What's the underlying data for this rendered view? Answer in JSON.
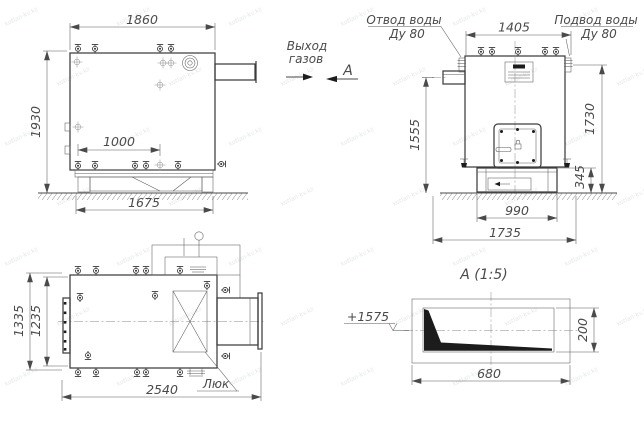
{
  "views": {
    "side": {
      "dim_top": "1860",
      "dim_left": "1930",
      "dim_inner": "1000",
      "dim_bottom": "1675",
      "gas_label_1": "Выход",
      "gas_label_2": "газов",
      "section_letter": "А"
    },
    "front": {
      "dim_top": "1405",
      "dim_left": "1555",
      "dim_right": "1730",
      "dim_base_h": "345",
      "dim_base_w": "990",
      "dim_ground": "1735",
      "outlet_label_1": "Отвод воды",
      "outlet_label_2": "Ду 80",
      "inlet_label_1": "Подвод воды",
      "inlet_label_2": "Ду 80"
    },
    "plan": {
      "dim_outer": "1335",
      "dim_inner": "1235",
      "dim_length": "2540",
      "hatch_label": "Люк"
    },
    "section": {
      "title": "А (1:5)",
      "dim_width": "680",
      "dim_height": "200",
      "elevation": "+1575"
    }
  },
  "icons": {
    "valve-icon": "handwheel-valve-glyph",
    "crosshair-icon": "position-target-cross",
    "flow-arrow-icon": "filled-right-arrow",
    "section-arrow-icon": "filled-left-arrow",
    "lock-icon": "padlock",
    "hatch-cross": "x-crossed-rectangle",
    "flange-port-icon": "concentric-circles-flange"
  },
  "watermark": {
    "text": "kotlan-kv.kz",
    "color": "#c9d2d9"
  },
  "colors": {
    "line": "#3d3d3d",
    "thin_line": "#5b5b5b",
    "dim_text": "#4a4a4a",
    "background": "#ffffff",
    "wedge_fill": "#1c1c1c"
  }
}
